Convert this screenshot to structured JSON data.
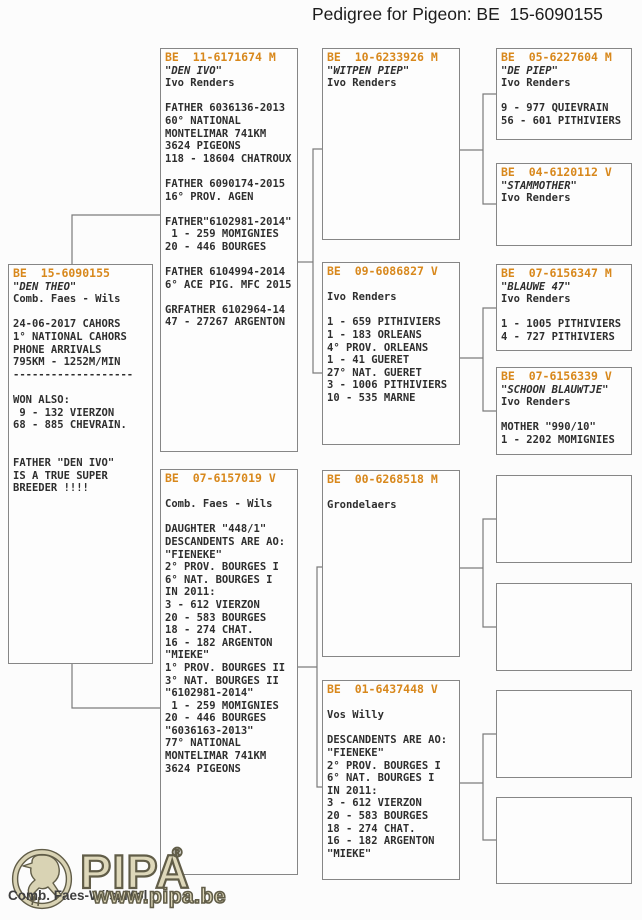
{
  "title": "Pedigree for Pigeon: BE  15-6090155",
  "accent_color": "#d8881c",
  "border_color": "#868686",
  "boxes": {
    "subject": {
      "header": "BE  15-6090155",
      "name": "\"DEN THEO\"",
      "body": "Comb. Faes - Wils\n\n24-06-2017 CAHORS\n1° NATIONAL CAHORS\nPHONE ARRIVALS\n795KM - 1252M/MIN\n-------------------\n\nWON ALSO:\n 9 - 132 VIERZON\n68 - 885 CHEVRAIN.\n\n\nFATHER \"DEN IVO\"\nIS A TRUE SUPER\nBREEDER !!!!"
    },
    "sire": {
      "header": "BE  11-6171674 M",
      "name": "\"DEN IVO\"",
      "body": "Ivo Renders\n\nFATHER 6036136-2013\n60° NATIONAL\nMONTELIMAR 741KM\n3624 PIGEONS\n118 - 18604 CHATROUX\n\nFATHER 6090174-2015\n16° PROV. AGEN\n\nFATHER\"6102981-2014\"\n 1 - 259 MOMIGNIES\n20 - 446 BOURGES\n\nFATHER 6104994-2014\n6° ACE PIG. MFC 2015\n\nGRFATHER 6102964-14\n47 - 27267 ARGENTON"
    },
    "dam": {
      "header": "BE  07-6157019 V",
      "name": "",
      "body": "Comb. Faes - Wils\n\nDAUGHTER \"448/1\"\nDESCANDENTS ARE AO:\n\"FIENEKE\"\n2° PROV. BOURGES I\n6° NAT. BOURGES I\nIN 2011:\n3 - 612 VIERZON\n20 - 583 BOURGES\n18 - 274 CHAT.\n16 - 182 ARGENTON\n\"MIEKE\"\n1° PROV. BOURGES II\n3° NAT. BOURGES II\n\"6102981-2014\"\n 1 - 259 MOMIGNIES\n20 - 446 BOURGES\n\"6036163-2013\"\n77° NATIONAL\nMONTELIMAR 741KM\n3624 PIGEONS"
    },
    "pgsire": {
      "header": "BE  10-6233926 M",
      "name": "\"WITPEN PIEP\"",
      "body": "Ivo Renders"
    },
    "pgdam": {
      "header": "BE  09-6086827 V",
      "name": "",
      "body": "Ivo Renders\n\n1 - 659 PITHIVIERS\n1 - 183 ORLEANS\n4° PROV. ORLEANS\n1 - 41 GUERET\n27° NAT. GUERET\n3 - 1006 PITHIVIERS\n10 - 535 MARNE"
    },
    "mgsire": {
      "header": "BE  00-6268518 M",
      "name": "",
      "body": "Grondelaers"
    },
    "mgdam": {
      "header": "BE  01-6437448 V",
      "name": "",
      "body": "Vos Willy\n\nDESCANDENTS ARE AO:\n\"FIENEKE\"\n2° PROV. BOURGES I\n6° NAT. BOURGES I\nIN 2011:\n3 - 612 VIERZON\n20 - 583 BOURGES\n18 - 274 CHAT.\n16 - 182 ARGENTON\n\"MIEKE\""
    },
    "ggp1": {
      "header": "BE  05-6227604 M",
      "name": "\"DE PIEP\"",
      "body": "Ivo Renders\n\n9 - 977 QUIEVRAIN\n56 - 601 PITHIVIERS"
    },
    "ggp2": {
      "header": "BE  04-6120112 V",
      "name": "\"STAMMOTHER\"",
      "body": "Ivo Renders"
    },
    "ggp3": {
      "header": "BE  07-6156347 M",
      "name": "\"BLAUWE 47\"",
      "body": "Ivo Renders\n\n1 - 1005 PITHIVIERS\n4 - 727 PITHIVIERS"
    },
    "ggp4": {
      "header": "BE  07-6156339 V",
      "name": "\"SCHOON BLAUWTJE\"",
      "body": "Ivo Renders\n\nMOTHER \"990/10\"\n1 - 2202 MOMIGNIES"
    }
  },
  "logo": {
    "brand": "PIPA",
    "registered": "®",
    "url": "www.pipa.be",
    "credit": "Comb. Faes-Wils, Mol"
  }
}
